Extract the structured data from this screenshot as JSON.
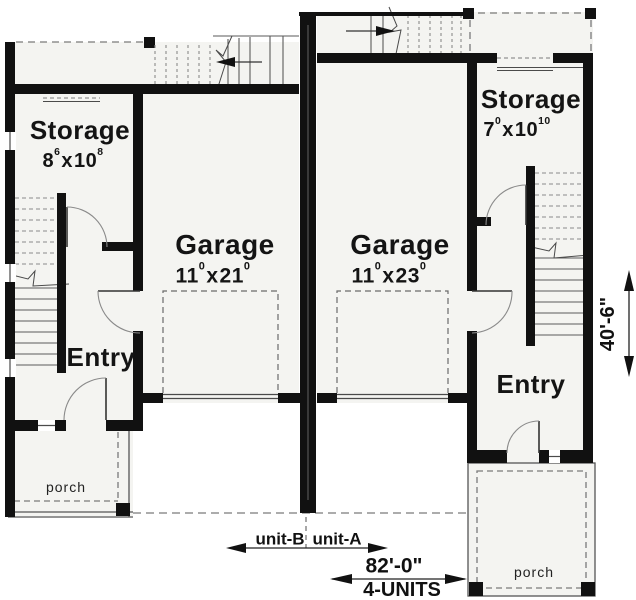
{
  "units": {
    "unit_b": {
      "storage_label": "Storage",
      "storage_dim": {
        "a": "8",
        "a_sup": "6",
        "sep": "x",
        "b": "10",
        "b_sup": "8"
      },
      "garage_label": "Garage",
      "garage_dim": {
        "a": "11",
        "a_sup": "0",
        "sep": "x",
        "b": "21",
        "b_sup": "0"
      },
      "entry_label": "Entry",
      "porch_label": "porch"
    },
    "unit_a": {
      "storage_label": "Storage",
      "storage_dim": {
        "a": "7",
        "a_sup": "0",
        "sep": "x",
        "b": "10",
        "b_sup": "10"
      },
      "garage_label": "Garage",
      "garage_dim": {
        "a": "11",
        "a_sup": "0",
        "sep": "x",
        "b": "23",
        "b_sup": "0"
      },
      "entry_label": "Entry",
      "porch_label": "porch"
    }
  },
  "dimensions": {
    "unit_b_tag": "unit-B",
    "unit_a_tag": "unit-A",
    "overall_width": "82'-0\"",
    "overall_width_sub": "4-UNITS",
    "overall_depth": "40'-6\""
  },
  "colors": {
    "wall": "#111111",
    "floor": "#f4f4f1",
    "thin_line": "#4a4a4a",
    "dash_line": "#7a7a7a"
  }
}
